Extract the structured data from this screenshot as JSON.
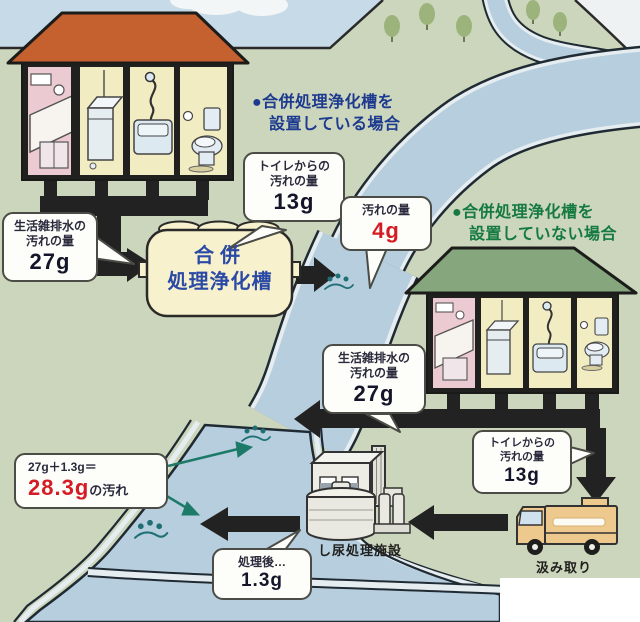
{
  "diagram": {
    "title_cases": {
      "with_tank": {
        "bullet": "●",
        "line1": "合併処理浄化槽を",
        "line2": "設置している場合"
      },
      "without_tank": {
        "bullet": "●",
        "line1": "合併処理浄化槽を",
        "line2": "設置していない場合"
      }
    },
    "septic_tank_label": {
      "line1": "合併",
      "line2": "処理浄化槽"
    },
    "callouts": {
      "toilet_house1": {
        "line1": "トイレからの",
        "line2": "汚れの量",
        "value": "13g"
      },
      "treated_outflow": {
        "line1": "汚れの量",
        "value": "4g"
      },
      "graywater_house1": {
        "line1": "生活雑排水の",
        "line2": "汚れの量",
        "value": "27g"
      },
      "graywater_house2": {
        "line1": "生活雑排水の",
        "line2": "汚れの量",
        "value": "27g"
      },
      "toilet_house2": {
        "line1": "トイレからの",
        "line2": "汚れの量",
        "value": "13g"
      },
      "river_total": {
        "line1": "27g＋1.3g＝",
        "value": "28.3g",
        "suffix": "の汚れ"
      },
      "after_treatment": {
        "line1": "処理後…",
        "value": "1.3g"
      }
    },
    "labels": {
      "treatment_facility": "し尿処理施設",
      "truck": "汲み取り"
    },
    "colors": {
      "accent_red": "#d41c24",
      "headline_blue": "#1d3a8f",
      "headline_green": "#157a40",
      "tank_text_blue": "#2b4aa6",
      "roof_red": "#c5602f",
      "roof_green": "#86a67e",
      "river_blue": "#b6cede",
      "pipe_black": "#222222",
      "ground_green": "#ccd6bc",
      "sky_blue": "#c7dae8"
    }
  }
}
